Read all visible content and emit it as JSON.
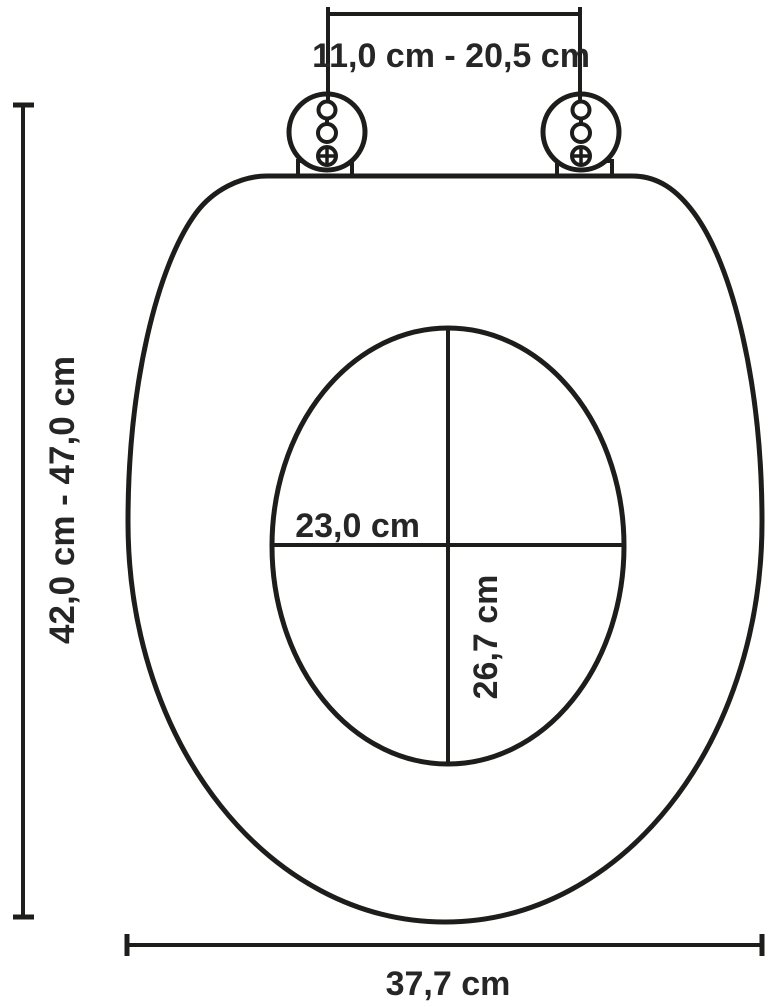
{
  "diagram": {
    "name": "toilet-seat-dimension-diagram",
    "line_color": "#1d1d1b",
    "text_color": "#262626",
    "background_color": "#ffffff",
    "labels": {
      "hinge_distance_range": "11,0 cm - 20,5 cm",
      "total_length_range": "42,0 cm - 47,0 cm",
      "inner_opening_width": "23,0 cm",
      "inner_opening_length": "26,7 cm",
      "total_width": "37,7 cm"
    }
  }
}
